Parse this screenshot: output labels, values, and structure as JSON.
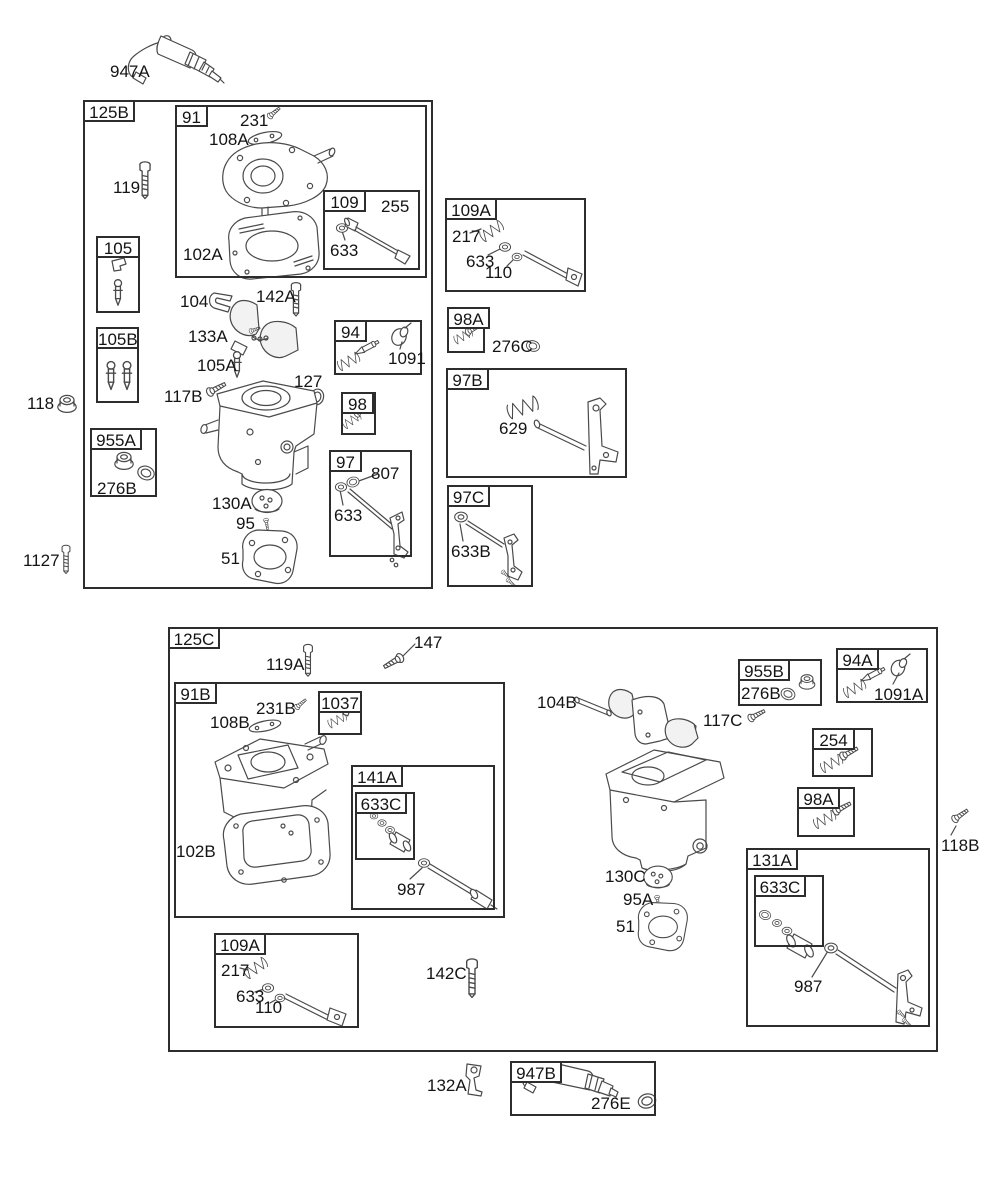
{
  "diagram": {
    "type": "exploded-parts-diagram",
    "subject": "carburetor assemblies",
    "colors": {
      "background": "#ffffff",
      "line": "#4a4a4a",
      "label_text": "#141414",
      "box_border": "#2d2d2d"
    },
    "group_boxes": [
      {
        "id": "125B",
        "label": "125B",
        "x": 83,
        "y": 100,
        "w": 350,
        "h": 489
      },
      {
        "id": "91",
        "label": "91",
        "x": 175,
        "y": 105,
        "w": 252,
        "h": 173
      },
      {
        "id": "109",
        "label": "109",
        "x": 323,
        "y": 190,
        "w": 97,
        "h": 80
      },
      {
        "id": "105",
        "label": "105",
        "x": 96,
        "y": 236,
        "w": 44,
        "h": 77,
        "tab": "full"
      },
      {
        "id": "105B",
        "label": "105B",
        "x": 96,
        "y": 327,
        "w": 43,
        "h": 76,
        "tab": "full"
      },
      {
        "id": "94",
        "label": "94",
        "x": 334,
        "y": 320,
        "w": 88,
        "h": 55
      },
      {
        "id": "98",
        "label": "98",
        "x": 341,
        "y": 392,
        "w": 35,
        "h": 43
      },
      {
        "id": "955A",
        "label": "955A",
        "x": 90,
        "y": 428,
        "w": 67,
        "h": 69
      },
      {
        "id": "97",
        "label": "97",
        "x": 329,
        "y": 450,
        "w": 83,
        "h": 107
      },
      {
        "id": "109A-1",
        "label": "109A",
        "x": 445,
        "y": 198,
        "w": 141,
        "h": 94
      },
      {
        "id": "98A-1",
        "label": "98A",
        "x": 447,
        "y": 307,
        "w": 38,
        "h": 46
      },
      {
        "id": "97B",
        "label": "97B",
        "x": 446,
        "y": 368,
        "w": 181,
        "h": 110
      },
      {
        "id": "97C",
        "label": "97C",
        "x": 447,
        "y": 485,
        "w": 86,
        "h": 102
      },
      {
        "id": "125C",
        "label": "125C",
        "x": 168,
        "y": 627,
        "w": 770,
        "h": 425
      },
      {
        "id": "91B",
        "label": "91B",
        "x": 174,
        "y": 682,
        "w": 331,
        "h": 236
      },
      {
        "id": "1037",
        "label": "1037",
        "x": 318,
        "y": 691,
        "w": 44,
        "h": 44,
        "tab": "full"
      },
      {
        "id": "141A",
        "label": "141A",
        "x": 351,
        "y": 765,
        "w": 144,
        "h": 145
      },
      {
        "id": "633C-141A",
        "label": "633C",
        "x": 355,
        "y": 792,
        "w": 60,
        "h": 68
      },
      {
        "id": "955B",
        "label": "955B",
        "x": 738,
        "y": 659,
        "w": 84,
        "h": 47
      },
      {
        "id": "94A",
        "label": "94A",
        "x": 836,
        "y": 648,
        "w": 92,
        "h": 55
      },
      {
        "id": "254",
        "label": "254",
        "x": 812,
        "y": 728,
        "w": 61,
        "h": 49
      },
      {
        "id": "98A-2",
        "label": "98A",
        "x": 797,
        "y": 787,
        "w": 58,
        "h": 50
      },
      {
        "id": "131A",
        "label": "131A",
        "x": 746,
        "y": 848,
        "w": 184,
        "h": 179
      },
      {
        "id": "633C-131A",
        "label": "633C",
        "x": 754,
        "y": 875,
        "w": 70,
        "h": 72
      },
      {
        "id": "109A-2",
        "label": "109A",
        "x": 214,
        "y": 933,
        "w": 145,
        "h": 95
      },
      {
        "id": "947B",
        "label": "947B",
        "x": 510,
        "y": 1061,
        "w": 146,
        "h": 55
      }
    ],
    "part_labels": [
      {
        "text": "947A",
        "x": 110,
        "y": 62
      },
      {
        "text": "231",
        "x": 240,
        "y": 111
      },
      {
        "text": "108A",
        "x": 209,
        "y": 130
      },
      {
        "text": "255",
        "x": 381,
        "y": 197
      },
      {
        "text": "633",
        "x": 330,
        "y": 241
      },
      {
        "text": "102A",
        "x": 183,
        "y": 245
      },
      {
        "text": "119",
        "x": 113,
        "y": 178
      },
      {
        "text": "104",
        "x": 180,
        "y": 292
      },
      {
        "text": "142A",
        "x": 256,
        "y": 287
      },
      {
        "text": "133A",
        "x": 188,
        "y": 327
      },
      {
        "text": "105A",
        "x": 197,
        "y": 356
      },
      {
        "text": "1091",
        "x": 388,
        "y": 349
      },
      {
        "text": "117B",
        "x": 164,
        "y": 387
      },
      {
        "text": "127",
        "x": 294,
        "y": 372
      },
      {
        "text": "276B",
        "x": 97,
        "y": 479
      },
      {
        "text": "807",
        "x": 371,
        "y": 464
      },
      {
        "text": "633",
        "x": 334,
        "y": 506
      },
      {
        "text": "130A",
        "x": 212,
        "y": 494
      },
      {
        "text": "95",
        "x": 236,
        "y": 514
      },
      {
        "text": "51",
        "x": 221,
        "y": 549
      },
      {
        "text": "118",
        "x": 27,
        "y": 394
      },
      {
        "text": "1127",
        "x": 23,
        "y": 551
      },
      {
        "text": "217",
        "x": 452,
        "y": 227
      },
      {
        "text": "633",
        "x": 466,
        "y": 252
      },
      {
        "text": "110",
        "x": 485,
        "y": 263
      },
      {
        "text": "276C",
        "x": 492,
        "y": 337
      },
      {
        "text": "629",
        "x": 499,
        "y": 419
      },
      {
        "text": "633B",
        "x": 451,
        "y": 542
      },
      {
        "text": "147",
        "x": 414,
        "y": 633
      },
      {
        "text": "119A",
        "x": 266,
        "y": 655
      },
      {
        "text": "231B",
        "x": 256,
        "y": 699
      },
      {
        "text": "108B",
        "x": 210,
        "y": 713
      },
      {
        "text": "102B",
        "x": 176,
        "y": 842
      },
      {
        "text": "987",
        "x": 397,
        "y": 880
      },
      {
        "text": "104B",
        "x": 537,
        "y": 693
      },
      {
        "text": "117C",
        "x": 703,
        "y": 711
      },
      {
        "text": "276B",
        "x": 741,
        "y": 684
      },
      {
        "text": "1091A",
        "x": 874,
        "y": 685
      },
      {
        "text": "118B",
        "x": 941,
        "y": 836
      },
      {
        "text": "130C",
        "x": 605,
        "y": 867
      },
      {
        "text": "95A",
        "x": 623,
        "y": 890
      },
      {
        "text": "51",
        "x": 616,
        "y": 917
      },
      {
        "text": "987",
        "x": 794,
        "y": 977
      },
      {
        "text": "217",
        "x": 221,
        "y": 961
      },
      {
        "text": "633",
        "x": 236,
        "y": 987
      },
      {
        "text": "110",
        "x": 255,
        "y": 998
      },
      {
        "text": "142C",
        "x": 426,
        "y": 964
      },
      {
        "text": "132A",
        "x": 427,
        "y": 1076
      },
      {
        "text": "276E",
        "x": 591,
        "y": 1094
      }
    ],
    "artwork": [
      "fuel-solenoid-947A",
      "screw-119",
      "screw-231",
      "cover-plate-108A",
      "carb-upper-cover-91",
      "gasket-102A",
      "needle-seat-109",
      "clip-105",
      "float-needles-105B",
      "clip-104",
      "bolt-142A",
      "choke-flaps-133A",
      "needle-105A",
      "needle-kit-94",
      "screw-117B",
      "o-ring-127",
      "screw-spring-98",
      "nut-955A",
      "o-ring-276B",
      "carb-body-125B",
      "throttle-link-97",
      "disc-130A",
      "screw-95",
      "gasket-51",
      "nut-118",
      "screw-1127",
      "governor-link-109A",
      "screw-spring-98A",
      "o-ring-276C",
      "link-spring-97B",
      "link-97C",
      "screw-147",
      "bolt-119A",
      "screw-231B",
      "cover-plate-108B",
      "carb-body-91B",
      "gasket-102B",
      "spring-1037",
      "jet-kit-141A",
      "seal-kit-633C",
      "washer-987",
      "pin-104B",
      "choke-lever",
      "screw-117C",
      "nut-955B",
      "needle-kit-94A",
      "screw-spring-254",
      "screw-118B",
      "carb-body-lower",
      "disc-130C",
      "screw-95A",
      "gasket-51-lower",
      "jet-kit-131A",
      "governor-link-109A-lower",
      "bolt-142C",
      "bracket-132A",
      "fuel-solenoid-947B",
      "o-ring-276E"
    ]
  }
}
